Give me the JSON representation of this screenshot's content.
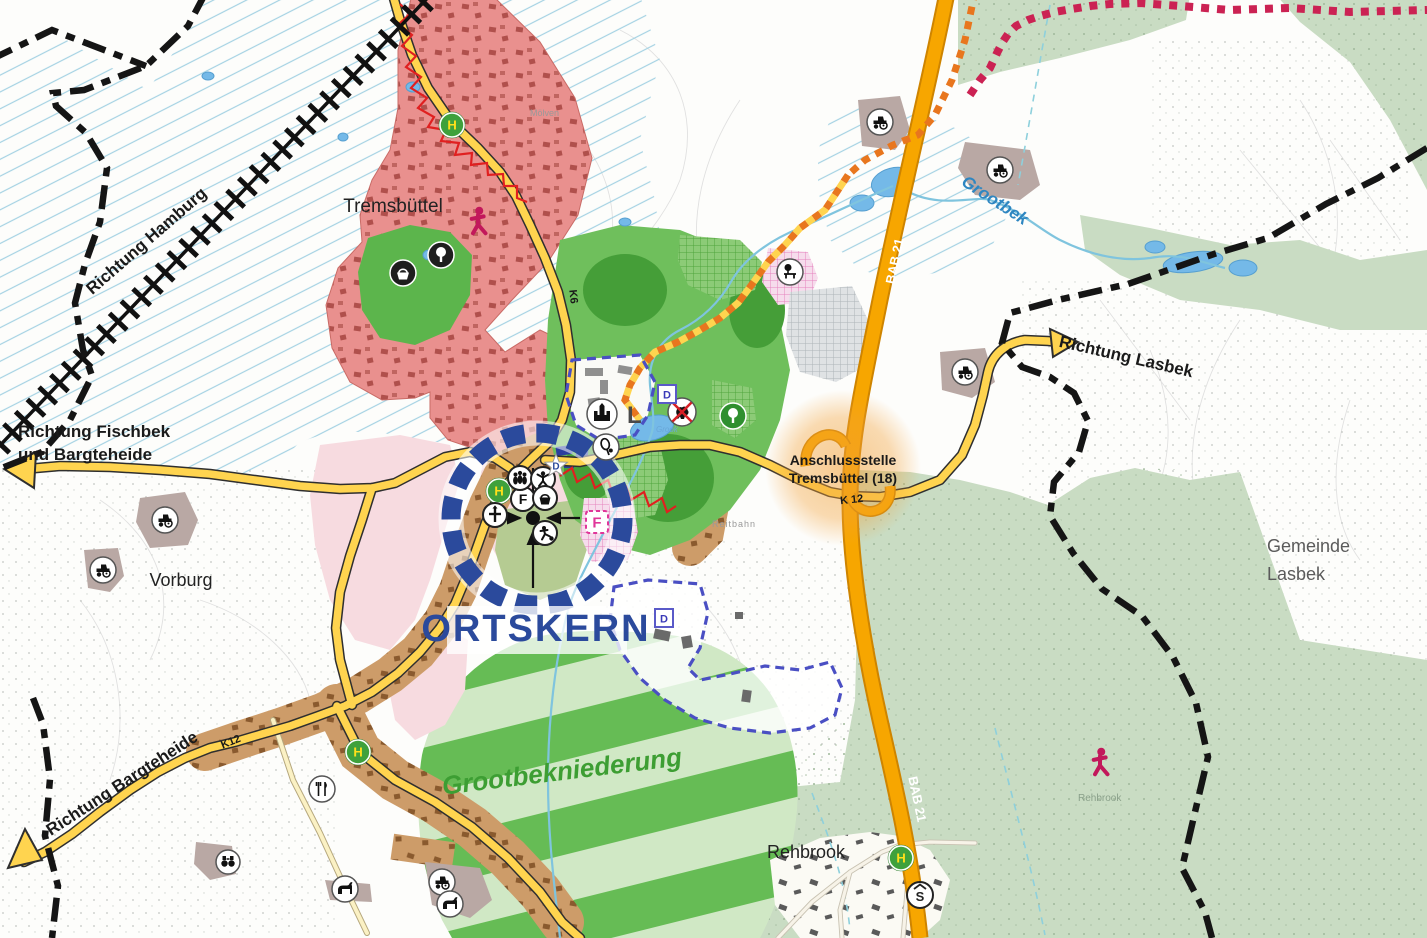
{
  "labels": {
    "richtung_hamburg": "Richtung Hamburg",
    "richtung_fischbek_1": "Richtung Fischbek",
    "richtung_fischbek_2": "und Bargteheide",
    "richtung_bargteheide": "Richtung Bargteheide",
    "richtung_lasbek": "Richtung Lasbek",
    "tremsbuettel": "Tremsbüttel",
    "vorburg": "Vorburg",
    "rehbrook": "Rehbrook",
    "gemeinde_lasbek_1": "Gemeinde",
    "gemeinde_lasbek_2": "Lasbek",
    "moelven": "Mölven",
    "reitbahn": "Reitbahn",
    "rehbrook_forest": "Rehbrook",
    "ortskern": "ORTSKERN",
    "grootbekniederung": "Grootbekniederung",
    "grootbek": "Grootbek",
    "grook": "Grook",
    "anschlussstelle_1": "Anschlussstelle",
    "anschlussstelle_2": "Tremsbüttel (18)"
  },
  "roads": {
    "bab21": "BAB 21",
    "k12_east": "K 12",
    "k12_sw": "K12",
    "k6": "K6"
  },
  "markers": {
    "bus_stop_h": "H",
    "school_s": "S",
    "center_f": "F",
    "area_f": "F",
    "castle_l": "L",
    "star_d": "D",
    "park_d": "D",
    "south_d": "D"
  },
  "icons": {
    "bus-stop-icon": "green circle with yellow H (Haltestelle)",
    "school-icon": "white circle, S with roof",
    "tree-icon": "deciduous tree in circle",
    "basket-icon": "harvest basket in circle",
    "crowd-icon": "group of people",
    "dancer-icon": "figure with raised arms",
    "soccer-icon": "soccer player with ball",
    "church-cross-icon": "cross marker",
    "castle-icon": "castle silhouette (Schloss)",
    "tennis-icon": "tennis racket and ball",
    "restaurant-icon": "fork and knife",
    "tractor-icon": "farm tractor",
    "horse-icon": "horse",
    "binoculars-icon": "binoculars viewpoint",
    "walker-icon": "red walking person",
    "no-entry-icon": "black animal crossed out red",
    "rest-area-icon": "rest area with tree and bench",
    "star-marker-icon": "white star with blue D",
    "center-target-icon": "black dot with four arrows"
  },
  "colors": {
    "highway": "#F7A600",
    "main_road": "#FFD44F",
    "residential": "#E9908E",
    "village": "#CD9C69",
    "park_green": "#63B952",
    "forest_pale": "#C9DCC3",
    "meadow_dark": "#66BC55",
    "meadow_light": "#D0E8C5",
    "water": "#74B9E8",
    "ortskern_blue": "#2B4A9C",
    "protected_dash_blue": "#4A4FC3",
    "trail_orange": "#E8761E",
    "trail_magenta": "#CB2253",
    "zigzag_red": "#E02020",
    "hatch_blue": "#A5D2E3",
    "pink_area": "#F7DBE0",
    "boundary_black": "#151515"
  }
}
